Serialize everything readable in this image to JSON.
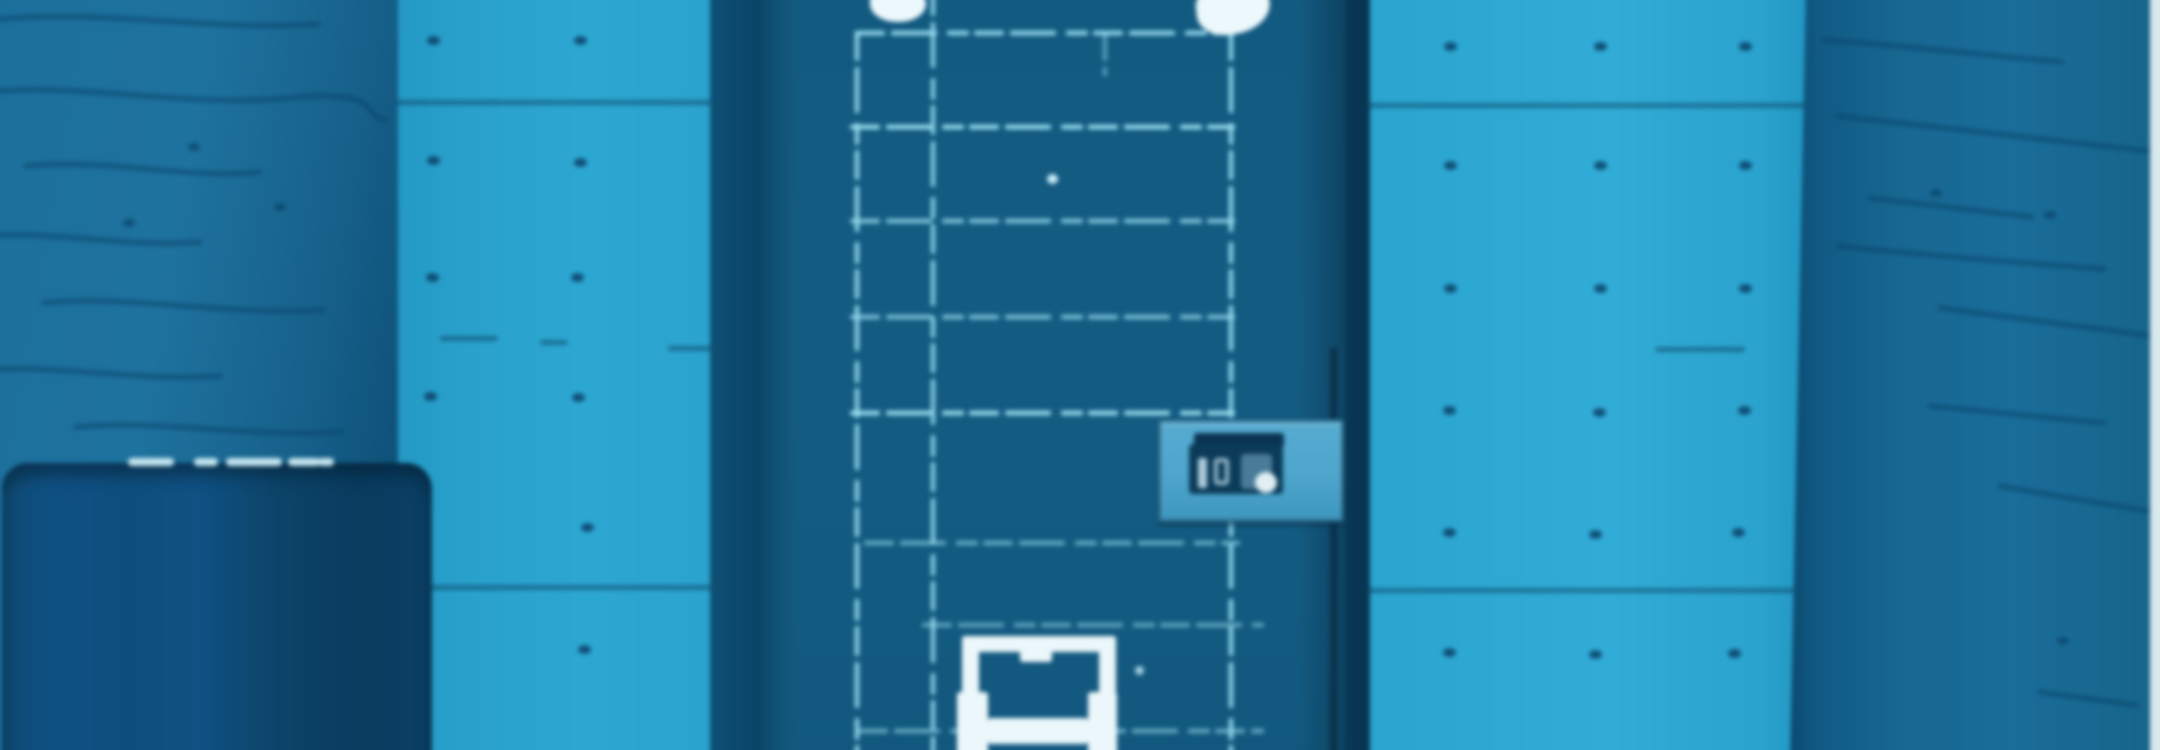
{
  "scene": {
    "type": "photograph",
    "palette": "blue monochrome tint",
    "description": "Out-of-focus blue-tinted photo of a heavy dark metal door with a welded panel grid, set between bare cast-concrete walls with form-tie holes; a small sign plate sits on the right of the door, a white pass-through hatch at the bottom centre, two white round fittings at the door top, and a dark bin stands at the lower left.",
    "width_px": 2160,
    "height_px": 750
  },
  "colors": {
    "wall_light": "#2fa7d1",
    "wall_light_left": "#2b9fc9",
    "wall_left_dark": "#1e6f99",
    "wall_right_dark": "#19678f",
    "crack": "#0b466a",
    "joint": "#0a3a58",
    "tie_hole": "#0a4064",
    "door_leaf": "#165b81",
    "door_frame": "#0d4a6e",
    "door_gap": "#0b4365",
    "grid_line": "#9adfef",
    "fitting_white": "#ecf8fb",
    "hatch_white": "#ebf7fa",
    "sign_plate": "#4fa5ca",
    "sign_label": "#0c3b58",
    "sign_glyph": "#bfdce8",
    "bin_dark": "#0f4a70",
    "bin_darker": "#0a3c5e",
    "bin_highlight": "#cfeef5",
    "edge_strip": "#d9e9ed"
  },
  "objects": {
    "door": "dark metal door with light welded grid seams",
    "sign": {
      "legible": false,
      "glyph_hint": "blurred marks resembling 035"
    },
    "hatch": "white-framed pass-through hatch at door bottom",
    "fittings": "two white round fittings at door top edge",
    "bin": "dark rounded bin at lower left",
    "walls": "concrete walls with horizontal joints, cracks and form-tie holes"
  },
  "walls": {
    "left_dark": {
      "cracks": [
        "M0,20 C110,8 230,32 330,24",
        "M0,92 C90,82 200,108 300,98 S370,116 398,120",
        "M38,166 C120,158 205,180 272,172",
        "M0,236 C60,230 140,248 212,242",
        "M56,303 C140,294 235,316 335,310",
        "M0,370 C70,364 152,382 232,376",
        "M88,427 C170,419 262,438 354,432"
      ],
      "spots": [
        [
          206,
          147
        ],
        [
          292,
          207
        ],
        [
          141,
          223
        ]
      ]
    },
    "left_light": {
      "joints": [
        {
          "x": 0,
          "y": 100,
          "w": 326
        },
        {
          "x": 54,
          "y": 336,
          "w": 58
        },
        {
          "x": 154,
          "y": 340,
          "w": 28
        },
        {
          "x": 282,
          "y": 346,
          "w": 44
        },
        {
          "x": 0,
          "y": 585,
          "w": 326
        }
      ],
      "tie_holes": [
        [
          47,
          40
        ],
        [
          194,
          40
        ],
        [
          47,
          160
        ],
        [
          194,
          162
        ],
        [
          46,
          277
        ],
        [
          191,
          277
        ],
        [
          44,
          396
        ],
        [
          192,
          397
        ],
        [
          201,
          527
        ],
        [
          198,
          649
        ]
      ]
    },
    "right_light": {
      "joints": [
        {
          "x": 0,
          "y": 103,
          "w": 442
        },
        {
          "x": 287,
          "y": 347,
          "w": 90
        },
        {
          "x": 0,
          "y": 588,
          "w": 430
        }
      ],
      "tie_holes": [
        [
          82,
          46
        ],
        [
          232,
          46
        ],
        [
          377,
          46
        ],
        [
          82,
          165
        ],
        [
          232,
          165
        ],
        [
          377,
          165
        ],
        [
          82,
          288
        ],
        [
          232,
          288
        ],
        [
          377,
          288
        ],
        [
          81,
          410
        ],
        [
          231,
          412
        ],
        [
          376,
          410
        ],
        [
          81,
          532
        ],
        [
          227,
          534
        ],
        [
          370,
          532
        ],
        [
          81,
          652
        ],
        [
          227,
          654
        ],
        [
          366,
          653
        ]
      ]
    },
    "right_dark": {
      "cracks": [
        "M34,40 C120,46 200,56 272,62",
        "M47,116 C140,127 262,140 368,152",
        "M80,198 C150,206 200,212 242,217",
        "M48,246 C122,254 222,262 314,269",
        "M150,308 C242,320 324,331 370,337",
        "M140,406 C202,412 264,418 314,423",
        "M210,486 C272,497 334,507 370,513",
        "M250,692 C290,698 324,702 346,705"
      ],
      "spots": [
        [
          146,
          193
        ],
        [
          260,
          215
        ],
        [
          273,
          641
        ]
      ]
    }
  },
  "door": {
    "grid": {
      "verticals": [
        {
          "x": 147,
          "y1": 33,
          "y2": 762,
          "o": 0.9
        },
        {
          "x": 223,
          "y1": -12,
          "y2": 762,
          "o": 0.85
        },
        {
          "x": 521,
          "y1": 33,
          "y2": 762,
          "o": 0.9
        },
        {
          "x": 395,
          "y1": 33,
          "y2": 74,
          "o": 0.5
        }
      ],
      "horizontals": [
        {
          "y": 33,
          "x1": 147,
          "x2": 523,
          "o": 0.95
        },
        {
          "y": 127,
          "x1": 142,
          "x2": 523,
          "o": 1
        },
        {
          "y": 221,
          "x1": 142,
          "x2": 523,
          "o": 0.8
        },
        {
          "y": 317,
          "x1": 142,
          "x2": 523,
          "o": 0.75
        },
        {
          "y": 413,
          "x1": 142,
          "x2": 523,
          "o": 1
        },
        {
          "y": 543,
          "x1": 156,
          "x2": 528,
          "o": 0.6
        },
        {
          "y": 625,
          "x1": 214,
          "x2": 552,
          "o": 0.55
        },
        {
          "y": 731,
          "x1": 150,
          "x2": 552,
          "o": 0.6
        }
      ]
    },
    "hatch_parts": [
      {
        "x": 252,
        "y": 636,
        "w": 153,
        "h": 16
      },
      {
        "x": 252,
        "y": 636,
        "w": 17,
        "h": 62
      },
      {
        "x": 389,
        "y": 636,
        "w": 17,
        "h": 64
      },
      {
        "x": 247,
        "y": 692,
        "w": 31,
        "h": 70
      },
      {
        "x": 378,
        "y": 692,
        "w": 29,
        "h": 70
      },
      {
        "x": 278,
        "y": 718,
        "w": 100,
        "h": 26
      },
      {
        "x": 310,
        "y": 650,
        "w": 32,
        "h": 12
      }
    ]
  },
  "bin": {
    "highlight_dashes": [
      {
        "x": 126,
        "w": 46
      },
      {
        "x": 192,
        "w": 24
      },
      {
        "x": 224,
        "w": 56
      },
      {
        "x": 286,
        "w": 32
      },
      {
        "x": 316,
        "w": 16
      }
    ]
  }
}
